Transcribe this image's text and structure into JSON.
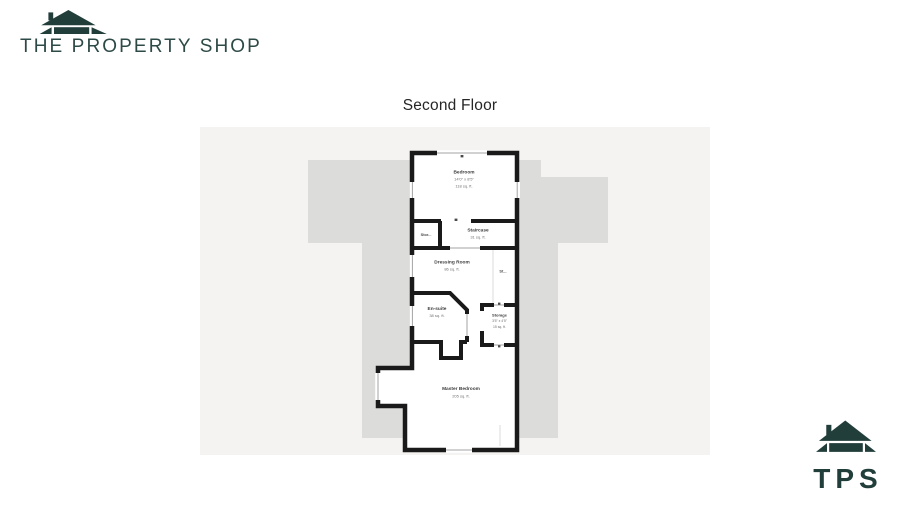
{
  "brand": {
    "name": "THE PROPERTY SHOP",
    "abbr": "TPS",
    "color": "#223e3b"
  },
  "title": "Second Floor",
  "plan": {
    "rooms": [
      {
        "name": "Bedroom",
        "dims": "14'0\" x 8'5\"",
        "area": "118 sq. ft."
      },
      {
        "name": "Stor...",
        "dims": "",
        "area": ""
      },
      {
        "name": "Staircase",
        "dims": "",
        "area": "31 sq. ft."
      },
      {
        "name": "Dressing Room",
        "dims": "",
        "area": "86 sq. ft."
      },
      {
        "name": "St...",
        "dims": "",
        "area": ""
      },
      {
        "name": "En-suite",
        "dims": "",
        "area": "38 sq. ft."
      },
      {
        "name": "Storage",
        "dims": "3'5\" x 4'5\"",
        "area": "15 sq. ft."
      },
      {
        "name": "Master Bedroom",
        "dims": "",
        "area": "205 sq. ft."
      }
    ]
  },
  "colors": {
    "brand": "#223e3b",
    "plan_background": "#f4f3f1",
    "silhouette": "#dcdcdb",
    "wall": "#1a1a1a"
  }
}
